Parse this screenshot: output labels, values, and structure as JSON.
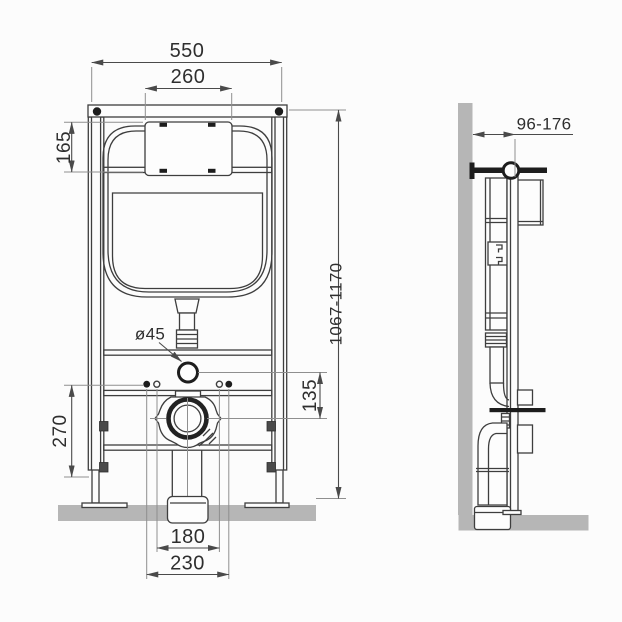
{
  "drawing": {
    "labels": {
      "frame_width": "550",
      "plate_width": "260",
      "plate_height": "165",
      "frame_height": "1067-1170",
      "inlet_diameter": "ø45",
      "inlet_to_outlet": "135",
      "lower_fixing_height": "270",
      "inner_bolt_spacing": "180",
      "outer_bolt_spacing": "230",
      "wall_offset": "96-176"
    },
    "colors": {
      "line": "#3e3e3e",
      "thin_line": "#8f8f8f",
      "black": "#1d1d1d",
      "masonry_gray": "#b6b6b6",
      "background": "#fcfcfc"
    }
  }
}
